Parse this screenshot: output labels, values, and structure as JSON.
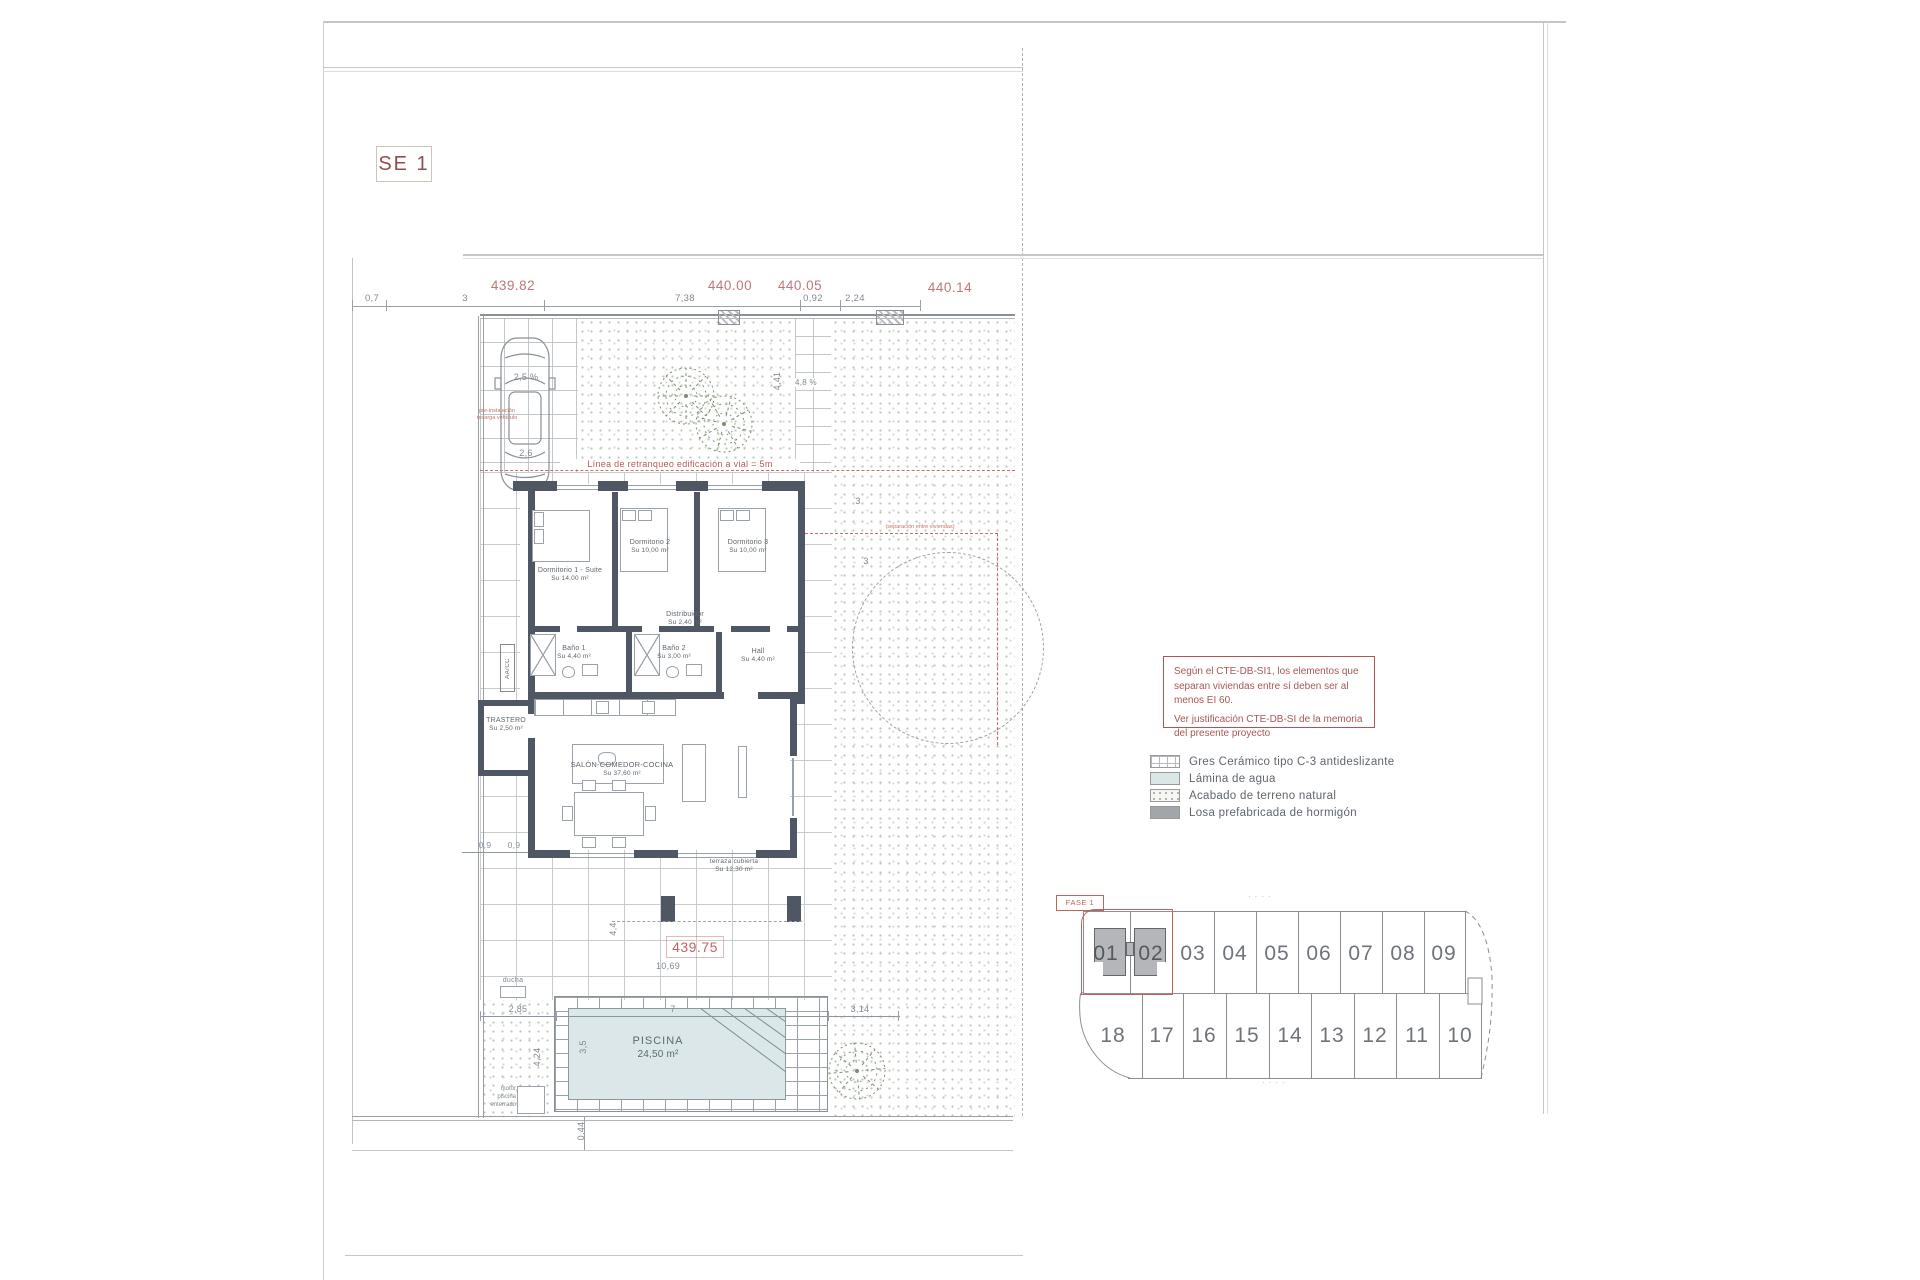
{
  "sheet": {
    "code": "SE 1"
  },
  "top_dims": {
    "e1": "439.82",
    "e2": "440.00",
    "e3": "440.05",
    "e4": "440.14",
    "d1": "0,7",
    "d2": "3",
    "d3": "7,38",
    "d4": "0,92",
    "d5": "2,24"
  },
  "site": {
    "setback": "Línea de retranqueo edificación a vial = 5m",
    "ev_note_1": "pre-instalación",
    "ev_note_2": "recarga vehículo",
    "slope_drive": "2,5 %",
    "car_width": "2,6",
    "dim_441": "4,41",
    "slope_side": "4,8 %",
    "dim_3a": "3",
    "dim_3b": "3",
    "sep_note": "(separación entre viviendas)",
    "dim_09a": "0,9",
    "dim_09b": "0,9",
    "dim_44": "4,4",
    "level": "439.75",
    "dim_1069": "10,69",
    "ducha": "ducha",
    "dim_285": "2,85",
    "dim_7": "7",
    "dim_314": "3,14",
    "dim_35": "3,5",
    "dim_424": "4,24",
    "dim_044": "0,44",
    "motor_1": "motor",
    "motor_2": "piscina",
    "motor_3": "enterrado"
  },
  "rooms": {
    "d1": {
      "name": "Dormitorio 1 - Suite",
      "area": "Su 14,00 m²"
    },
    "d2": {
      "name": "Dormitorio 2",
      "area": "Su 10,00 m²"
    },
    "d3": {
      "name": "Dormitorio 3",
      "area": "Su 10,00 m²"
    },
    "dist": {
      "name": "Distribuidor",
      "area": "Su 2,40 m²"
    },
    "b1": {
      "name": "Baño 1",
      "area": "Su 4,40 m²"
    },
    "b2": {
      "name": "Baño 2",
      "area": "Su 3,00 m²"
    },
    "hall": {
      "name": "Hall",
      "area": "Su 4,40 m²"
    },
    "tras": {
      "name": "TRASTERO",
      "area": "Su 2,50 m²"
    },
    "salon": {
      "name": "SALÓN-COMEDOR-COCINA",
      "area": "Su 37,60 m²"
    },
    "terraza": {
      "name": "terraza cubierta",
      "area": "Su 12,30 m²"
    },
    "aacc": "AA/CC"
  },
  "pool": {
    "name": "PISCINA",
    "area": "24,50 m²"
  },
  "note_box": {
    "p1": "Según el CTE-DB-SI1, los elementos que separan viviendas entre sí deben ser al menos EI 60.",
    "p2": "Ver justificación CTE-DB-SI de la memoria del presente proyecto"
  },
  "legend": {
    "items": [
      {
        "label": "Gres Cerámico tipo C-3 antideslizante",
        "swatch": "ceramic-grid"
      },
      {
        "label": "Lámina de agua",
        "swatch": "water"
      },
      {
        "label": "Acabado de terreno natural",
        "swatch": "terrain"
      },
      {
        "label": "Losa prefabricada de hormigón",
        "swatch": "concrete"
      }
    ]
  },
  "lots": {
    "phase": "FASE 1",
    "top": [
      "01",
      "02",
      "03",
      "04",
      "05",
      "06",
      "07",
      "08",
      "09"
    ],
    "bottom": [
      "18",
      "17",
      "16",
      "15",
      "14",
      "13",
      "12",
      "11",
      "10"
    ]
  },
  "marks": {
    "dots_top": "····",
    "dots_bottom": "····"
  },
  "colors": {
    "accent_red": "#b05552",
    "elevation_pink": "#c0777b",
    "wall": "#4e5763",
    "water": "#dbe7e8"
  }
}
